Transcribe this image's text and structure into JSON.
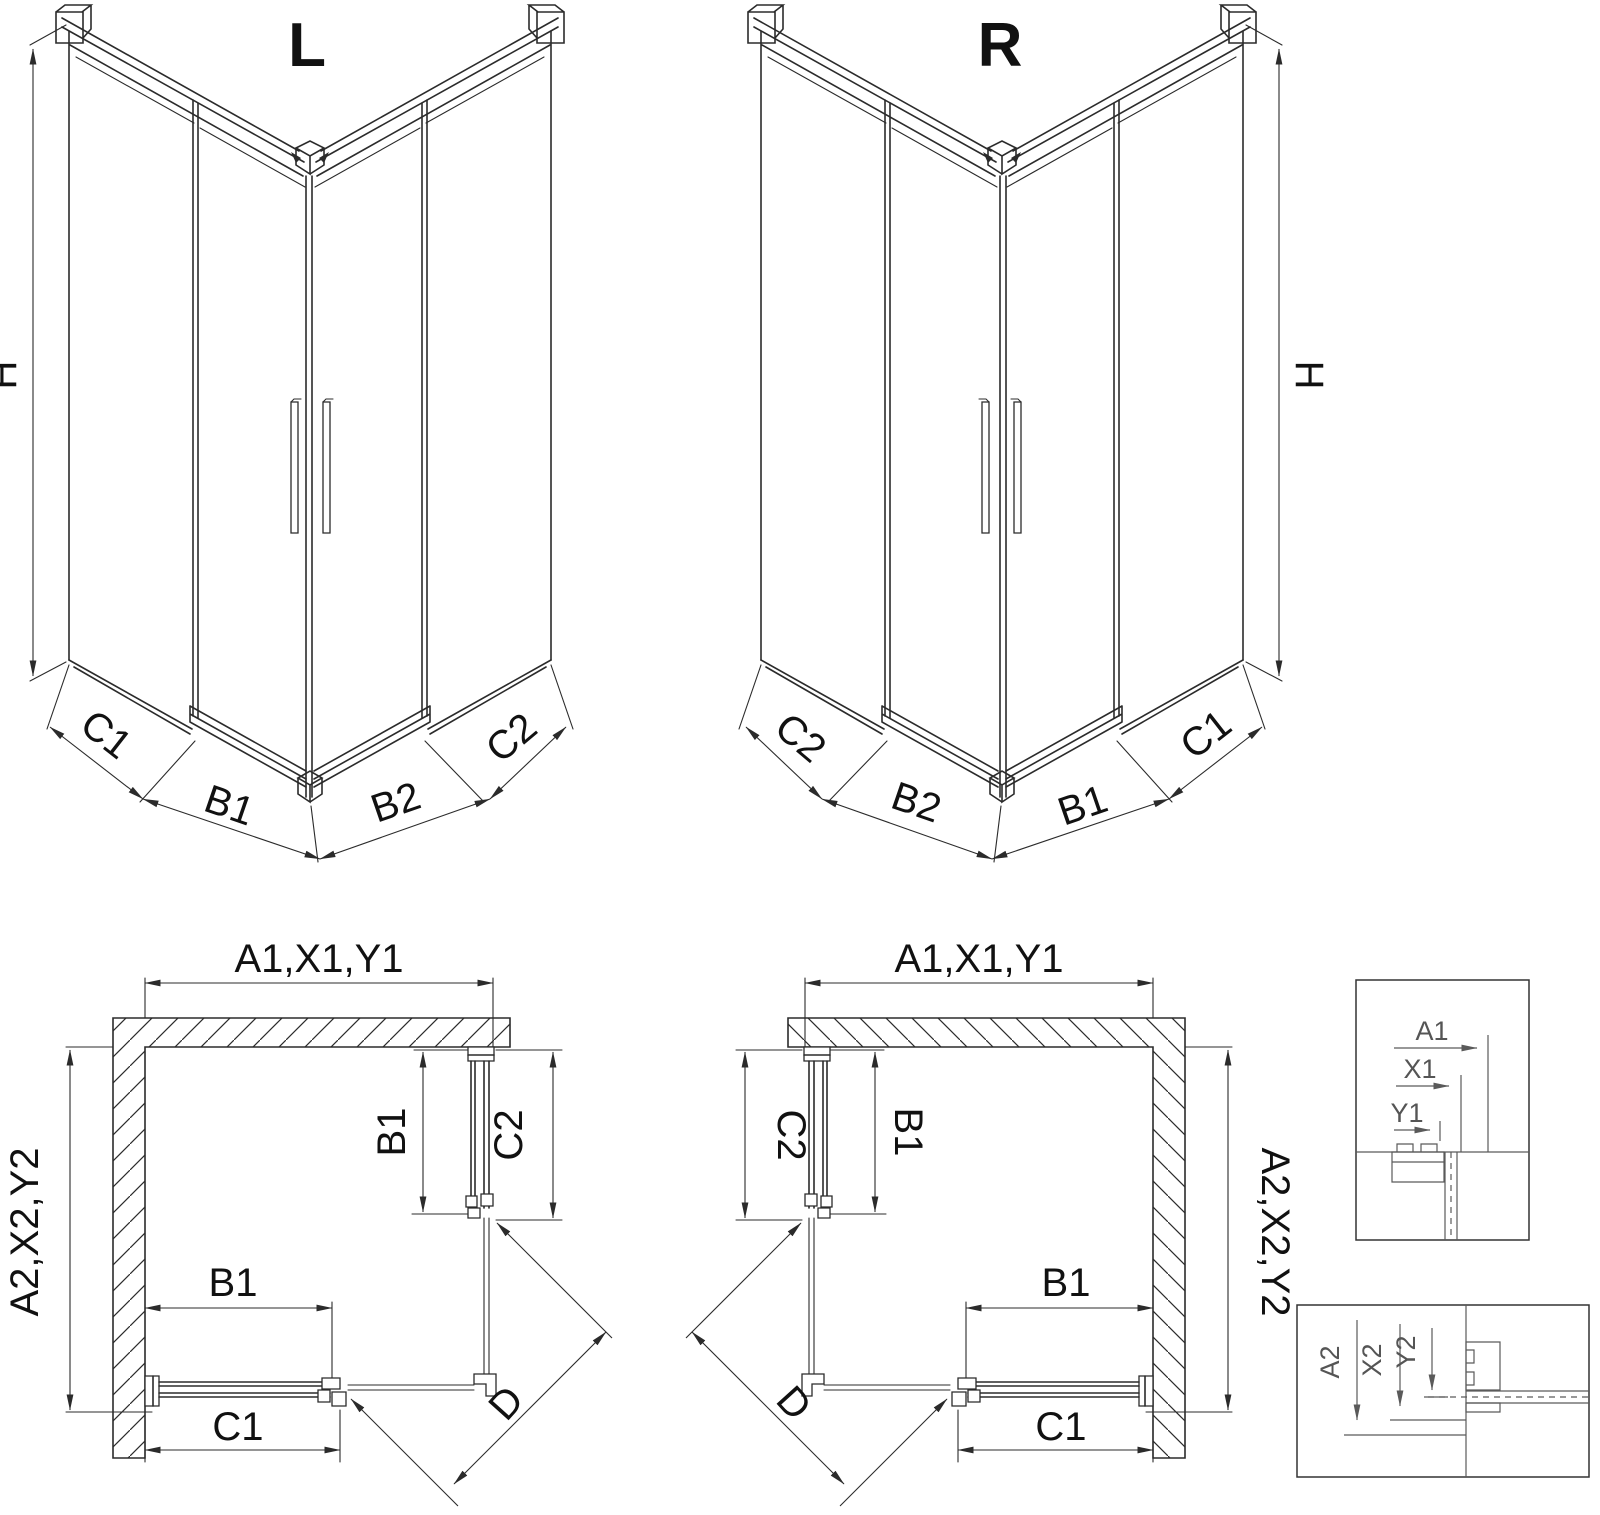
{
  "drawing": {
    "background": "#ffffff",
    "line_color": "#2b2b2b",
    "detail_line_color": "#5a5a5a",
    "text_color": "#111111"
  },
  "iso_left": {
    "title": "L",
    "height_dim": "H",
    "bottom_dims": [
      "C1",
      "B1",
      "B2",
      "C2"
    ]
  },
  "iso_right": {
    "title": "R",
    "height_dim": "H",
    "bottom_dims": [
      "C2",
      "B2",
      "B1",
      "C1"
    ]
  },
  "plan_left": {
    "width_dim": "A1,X1,Y1",
    "depth_dim": "A2,X2,Y2",
    "side_door_dims": [
      "B1",
      "C2"
    ],
    "bottom_door_dim": "B1",
    "bottom_outer_dim": "C1",
    "diagonal_dim": "D"
  },
  "plan_right": {
    "width_dim": "A1,X1,Y1",
    "depth_dim": "A2,X2,Y2",
    "side_door_dims": [
      "C2",
      "B1"
    ],
    "bottom_door_dim": "B1",
    "bottom_outer_dim": "C1",
    "diagonal_dim": "D"
  },
  "detail_width": {
    "dims": [
      "A1",
      "X1",
      "Y1"
    ]
  },
  "detail_depth": {
    "dims": [
      "A2",
      "X2",
      "Y2"
    ]
  }
}
